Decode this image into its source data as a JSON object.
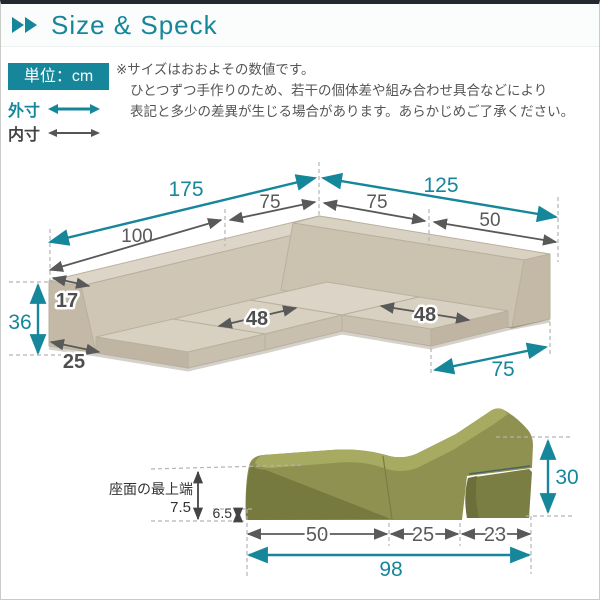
{
  "page": {
    "title": "Size & Speck"
  },
  "legend": {
    "unit_label": "単位：cm",
    "outer_label": "外寸",
    "inner_label": "内寸"
  },
  "notes": {
    "line1": "※サイズはおおよその数値です。",
    "line2": "ひとつずつ手作りのため、若干の個体差や組み合わせ具合などにより",
    "line3": "表記と多少の差異が生じる場合があります。あらかじめご了承ください。"
  },
  "sofa_dims": {
    "outer_left": "175",
    "outer_right": "125",
    "inner_left_back": "100",
    "inner_left_corner": "75",
    "inner_right_corner": "75",
    "inner_right_back": "50",
    "back_height": "36",
    "back_top_depth": "17",
    "back_base_depth": "25",
    "left_seat_width": "48",
    "right_seat_width": "48",
    "right_wing_depth": "75"
  },
  "chair_dims": {
    "seat_top_label": "座面の最上端",
    "seat_top_height": "7.5",
    "front_edge_height": "6.5",
    "seat_section": "50",
    "middle_section": "25",
    "back_section": "23",
    "total_length": "98",
    "back_height": "30"
  },
  "colors": {
    "accent_teal": "#16869b",
    "arrow_gray": "#595959",
    "dark_text": "#333333",
    "sofa_beige": "#d5cdbd",
    "chair_green": "#8e9150",
    "top_bar": "#23272e"
  }
}
